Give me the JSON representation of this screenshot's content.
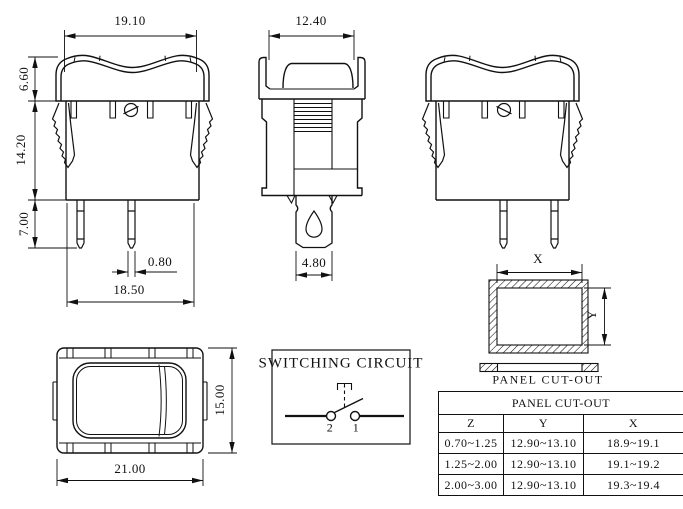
{
  "drawing": {
    "front_view": {
      "dim_top_width": "19.10",
      "dim_bezel_height": "6.60",
      "dim_body_height": "14.20",
      "dim_terminal_length": "7.00",
      "dim_terminal_width": "0.80",
      "dim_bottom_width": "18.50"
    },
    "side_view": {
      "dim_top_width": "12.40",
      "dim_terminal_width": "4.80"
    },
    "top_view": {
      "dim_width": "21.00",
      "dim_height": "15.00"
    },
    "panel_cutout": {
      "dim_x": "X",
      "dim_y": "Y",
      "caption": "PANEL CUT-OUT"
    },
    "circuit": {
      "title": "SWITCHING CIRCUIT",
      "terminal_left": "2",
      "terminal_right": "1"
    }
  },
  "table": {
    "title": "PANEL CUT-OUT",
    "columns": [
      "Z",
      "Y",
      "X"
    ],
    "rows": [
      {
        "z": "0.70~1.25",
        "y": "12.90~13.10",
        "x": "18.9~19.1"
      },
      {
        "z": "1.25~2.00",
        "y": "12.90~13.10",
        "x": "19.1~19.2"
      },
      {
        "z": "2.00~3.00",
        "y": "12.90~13.10",
        "x": "19.3~19.4"
      }
    ]
  },
  "colors": {
    "line": "#111111",
    "background": "#ffffff"
  }
}
